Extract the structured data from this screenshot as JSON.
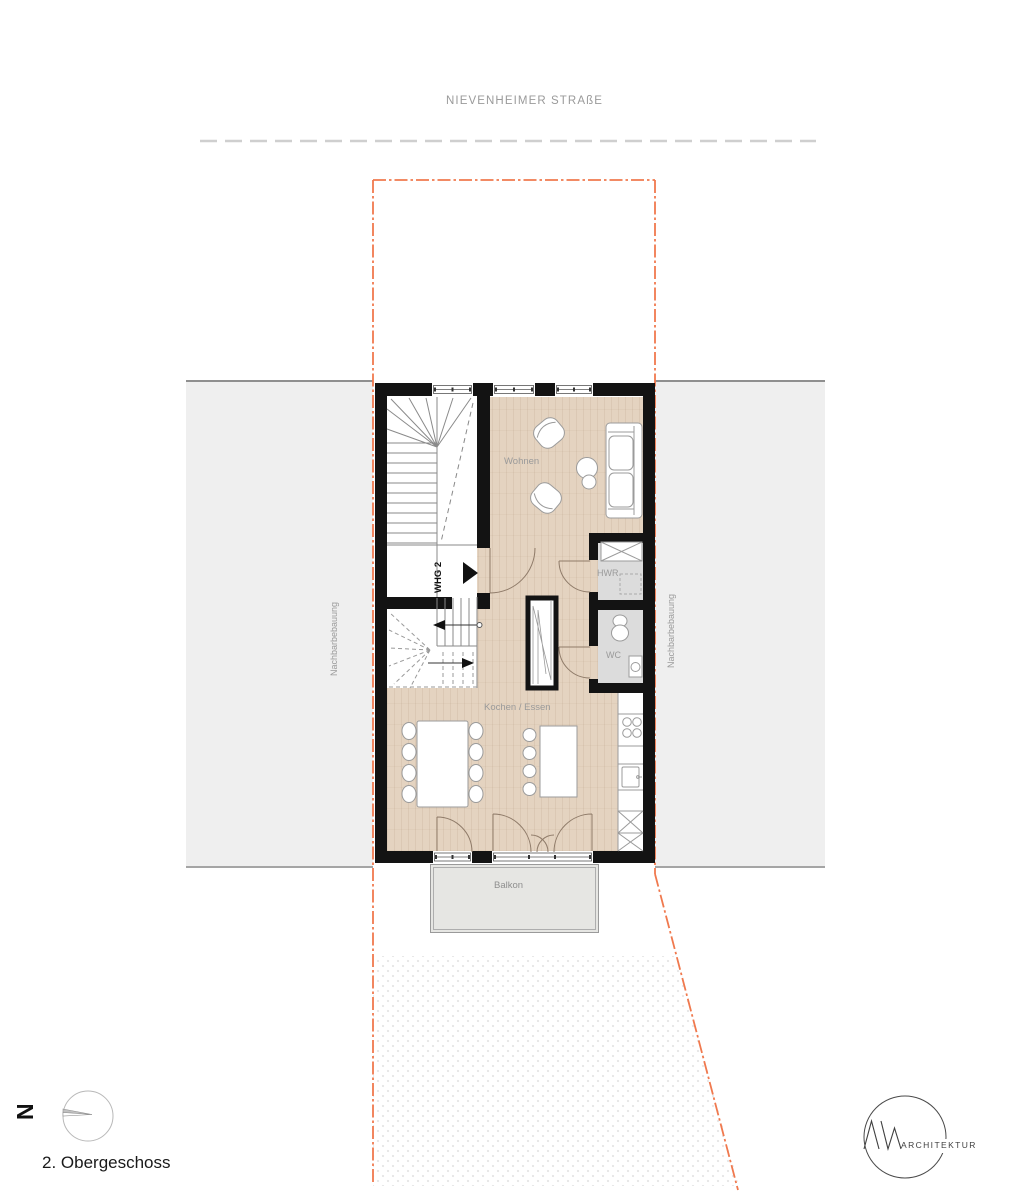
{
  "page": {
    "street_label": "NIEVENHEIMER STRAßE",
    "floor_label": "2. Obergeschoss"
  },
  "plan": {
    "unit_label": "WHG 2",
    "rooms": {
      "wohnen": "Wohnen",
      "kochen_essen": "Kochen / Essen",
      "hwr": "HWR",
      "wc": "WC",
      "balkon": "Balkon"
    },
    "neighbors": {
      "left": "Nachbarbebauung",
      "right": "Nachbarbebauung"
    }
  },
  "compass": {
    "north_label": "N"
  },
  "logo": {
    "monogram": "AW",
    "name": "ARCHITEKTUR"
  },
  "colors": {
    "boundary_orange": "#f0794e",
    "street_dash_gray": "#cfcfcf",
    "wall_black": "#131313",
    "wood_floor": "#e4d3c0",
    "neighbor_gray": "#efefef",
    "room_gray": "#dcdcdc",
    "balcony_gray": "#e6e6e3",
    "label_gray": "#9a9a9a"
  }
}
